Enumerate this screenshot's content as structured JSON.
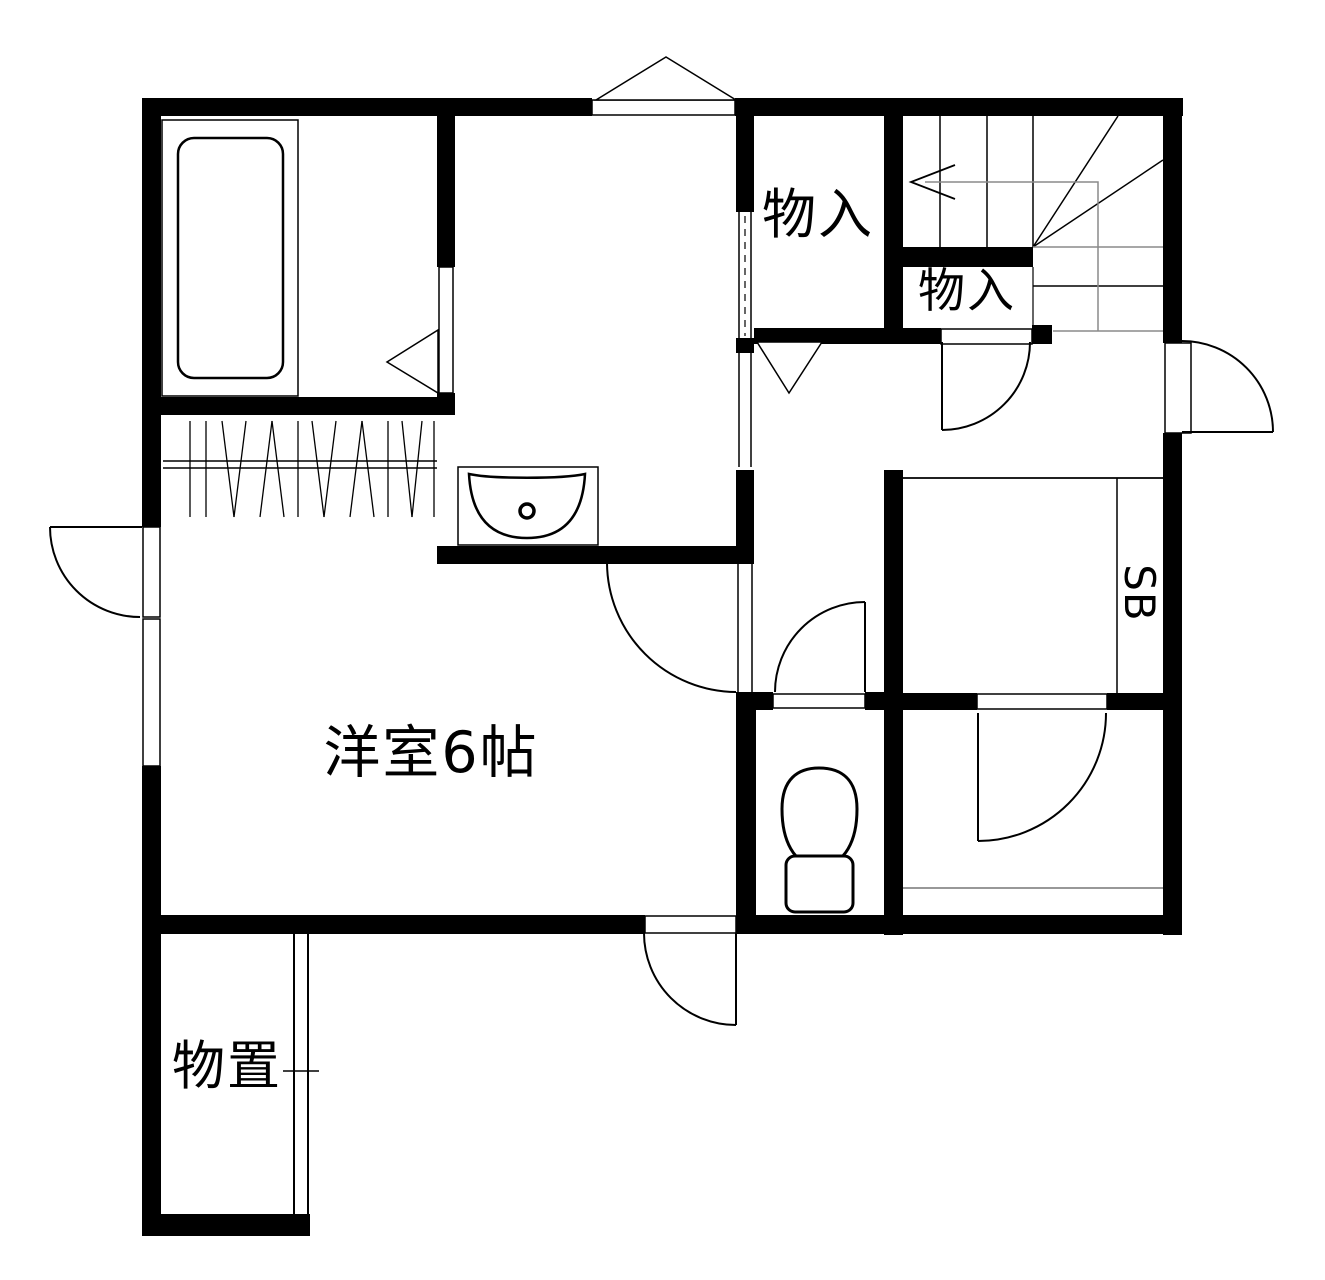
{
  "floor_plan": {
    "labels": {
      "closet_upper": "物入",
      "closet_lower": "物入",
      "western_room": "洋室6帖",
      "storage_shed": "物置",
      "shoe_box": "SB"
    },
    "fixtures": [
      "bathtub-icon",
      "washbasin-icon",
      "toilet-icon",
      "staircase",
      "clothes-hanger-rod",
      "sliding-door",
      "door-swing-arc",
      "door-swing-triangle",
      "window-triangle"
    ],
    "colors": {
      "wall": "#000000",
      "line": "#000000",
      "guide_line": "#8a8a8a",
      "background": "#ffffff"
    }
  }
}
